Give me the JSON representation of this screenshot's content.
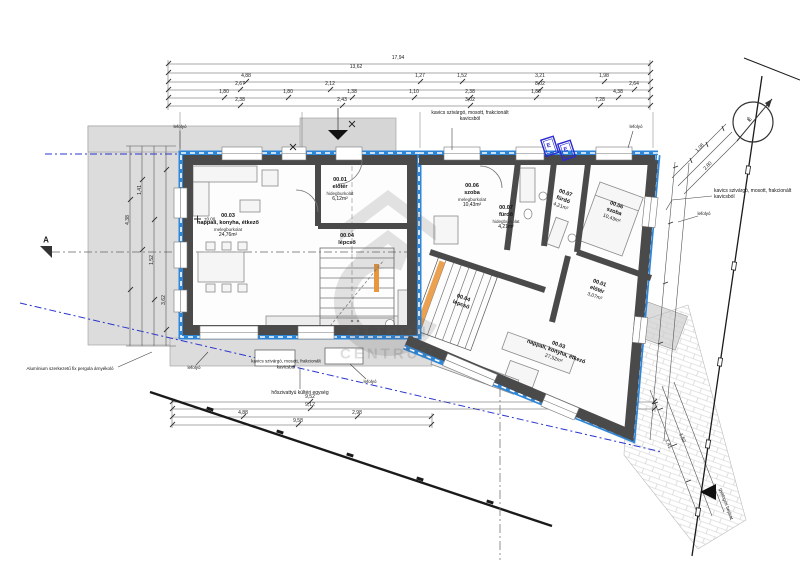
{
  "drawing": {
    "watermark_line1": "OTTHON",
    "watermark_line2": "CENTRUM",
    "section_marker": "A",
    "north_label": "É",
    "level_marker": "±0,00",
    "stamp_label": "E"
  },
  "rooms": {
    "left_unit": {
      "living": {
        "id": "00.03",
        "name": "nappali, konyha, étkező",
        "floor": "melegburkolat",
        "area": "24,76m²"
      },
      "hall": {
        "id": "00.01",
        "name": "előtér",
        "floor": "hidegburkolat",
        "area": "6,12m²"
      },
      "stairs": {
        "id": "00.04",
        "name": "lépcső"
      }
    },
    "right_unit": {
      "room1": {
        "id": "00.06",
        "name": "szoba",
        "floor": "melegburkolat",
        "area": "10,43m²"
      },
      "bath1": {
        "id": "00.07",
        "name": "fürdő",
        "floor": "hidegburkolat",
        "area": "4,21m²"
      },
      "bath2": {
        "id": "00.07",
        "name": "fürdő",
        "area": "4,21m²"
      },
      "room2": {
        "id": "00.06",
        "name": "szoba",
        "area": "10,43m²"
      },
      "hall2": {
        "id": "00.01",
        "name": "előtér",
        "area": "3,07m²"
      },
      "stairs2": {
        "id": "00.04",
        "name": "lépcső"
      },
      "living2": {
        "id": "00.03",
        "name": "nappali, konyha, étkező",
        "area": "27,52m²"
      }
    }
  },
  "notes": {
    "gravel": "kavics szivárgó, mosott, frakcionált kavicsból",
    "drain": "lefolyó",
    "pergola": "Alumínium szerkezetű fix pergola árnyékoló",
    "heat_pump": "hőszivattyú kültéri egység",
    "access": "gyalogos bejárat"
  },
  "dims": {
    "top_total": "17,94",
    "top_sub": "13,62",
    "top_row3": [
      "4,88",
      "1,27",
      "1,52",
      "3,21",
      "1,98"
    ],
    "top_row4": [
      "2,67",
      "2,12",
      "8,02",
      "2,64"
    ],
    "top_row5": [
      "1,80",
      "1,80",
      "1,38",
      "1,10",
      "2,38",
      "1,80",
      "4,38"
    ],
    "top_row6": [
      "2,38",
      "2,43",
      "3,02",
      "7,28"
    ],
    "bottom": [
      "9,52",
      "9,12",
      "4,88",
      "2,98",
      "9,58"
    ],
    "left": [
      "4,38",
      "1,41",
      "1,52",
      "3,62"
    ],
    "right": [
      "1,08",
      "2,80",
      "1,41",
      "1,52"
    ]
  }
}
